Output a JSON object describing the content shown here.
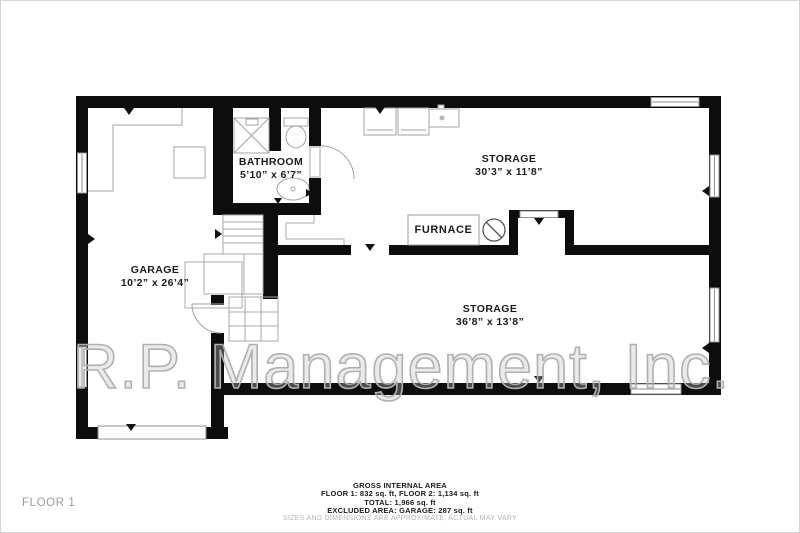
{
  "watermark": "R.P. Management, Inc.",
  "floor_label": "FLOOR 1",
  "rooms": [
    {
      "id": "garage",
      "name": "GARAGE",
      "dims": "10’2” x 26’4”"
    },
    {
      "id": "bathroom",
      "name": "BATHROOM",
      "dims": "5’10” x 6’7”"
    },
    {
      "id": "storage-upper",
      "name": "STORAGE",
      "dims": "30’3” x 11’8”"
    },
    {
      "id": "storage-lower",
      "name": "STORAGE",
      "dims": "36’8” x 13’8”"
    }
  ],
  "furnace_label": "FURNACE",
  "footer": {
    "lines": [
      "GROSS INTERNAL AREA",
      "FLOOR 1: 832 sq. ft, FLOOR 2: 1,134 sq. ft",
      "TOTAL: 1,966 sq. ft",
      "EXCLUDED AREA: GARAGE: 287 sq. ft"
    ],
    "disclaimer": "SIZES AND DIMENSIONS ARE APPROXIMATE, ACTUAL MAY VARY"
  },
  "colors": {
    "wall": "#0d0d0d",
    "furniture_line": "#a3a3a3",
    "window_line": "#8f8f8f"
  }
}
